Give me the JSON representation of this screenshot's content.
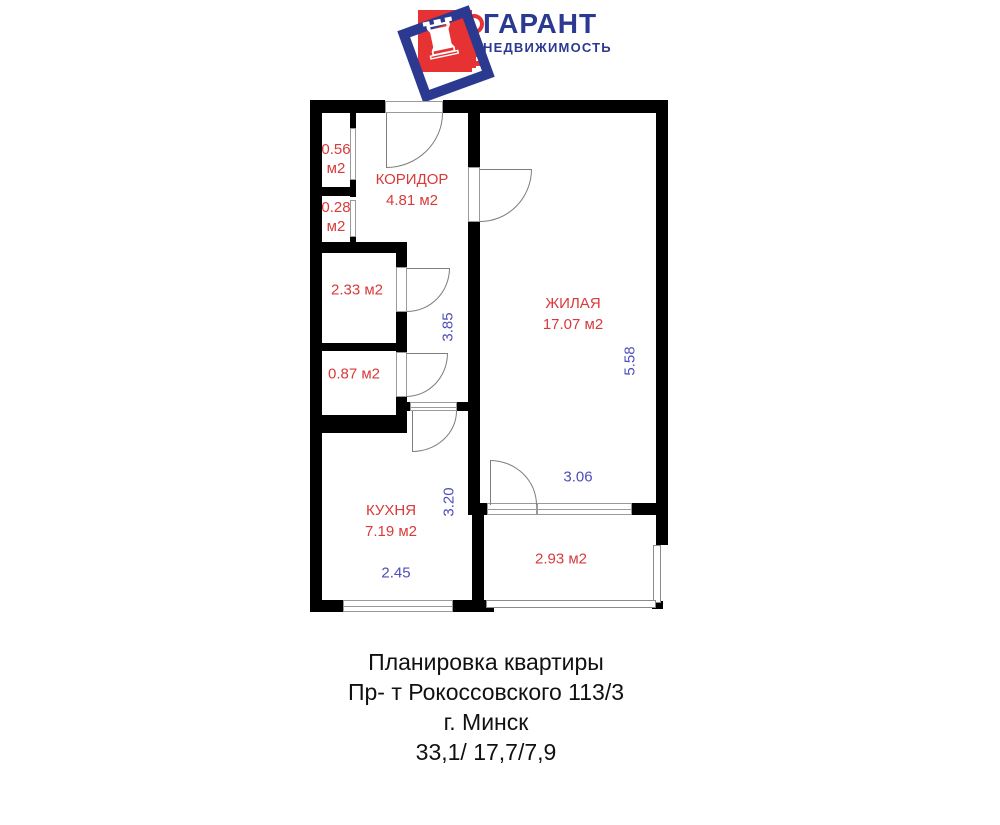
{
  "logo": {
    "title": "ГАРАНТ",
    "subtitle": "НЕДВИЖИМОСТЬ",
    "rook_icon": "♜"
  },
  "colors": {
    "wall": "#000000",
    "room_label": "#d93a3a",
    "dimension": "#4d4dbb",
    "brand_blue": "#2b3990",
    "brand_red": "#e63232",
    "caption": "#111111"
  },
  "plan": {
    "rooms": [
      {
        "id": "corridor",
        "text": "КОРИДОР\n4.81 м2"
      },
      {
        "id": "living",
        "text": "ЖИЛАЯ\n17.07 м2"
      },
      {
        "id": "kitchen",
        "text": "КУХНЯ\n7.19 м2"
      },
      {
        "id": "balcony",
        "text": "2.93 м2"
      },
      {
        "id": "closet-top",
        "text": "0.56\nм2"
      },
      {
        "id": "closet-lower",
        "text": "0.28\nм2"
      },
      {
        "id": "bathroom",
        "text": "2.33 м2"
      },
      {
        "id": "wc",
        "text": "0.87 м2"
      }
    ],
    "dimensions": [
      {
        "id": "corridor-length",
        "text": "3.85"
      },
      {
        "id": "kitchen-length",
        "text": "3.20"
      },
      {
        "id": "living-length",
        "text": "5.58"
      },
      {
        "id": "living-width",
        "text": "3.06"
      },
      {
        "id": "kitchen-width",
        "text": "2.45"
      }
    ]
  },
  "caption": {
    "lines": [
      "Планировка квартиры",
      "Пр- т Рокоссовского 113/3",
      "г. Минск",
      "33,1/ 17,7/7,9"
    ]
  }
}
